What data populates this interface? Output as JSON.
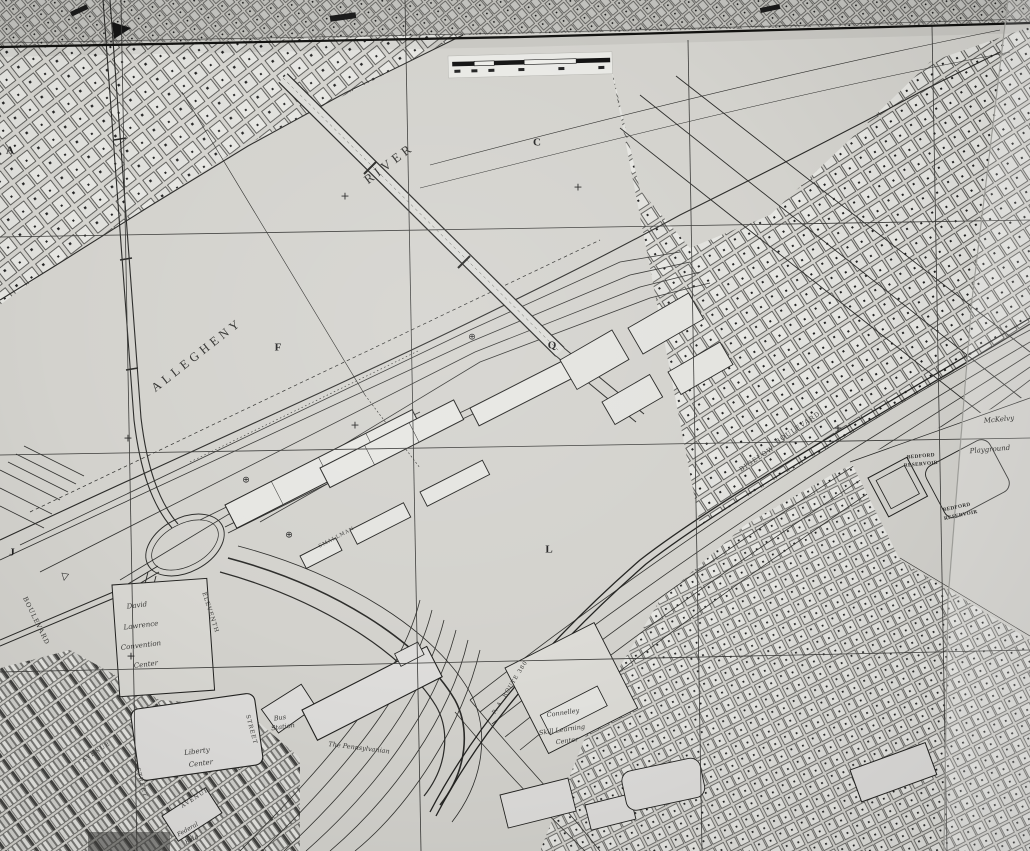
{
  "meta": {
    "kind": "scanned city planning map sheet",
    "colors": {
      "paper": "#d3d2cd",
      "paper_light": "#e2e2de",
      "ink": "#222220"
    }
  },
  "river": {
    "name_word1": "ALLEGHENY",
    "name_word2": "RIVER"
  },
  "grid_letters": {
    "a": "A",
    "c": "C",
    "f": "F",
    "q": "Q",
    "j": "J",
    "l": "L"
  },
  "places": {
    "convention_center": {
      "l1": "David",
      "l2": "Lawrence",
      "l3": "Convention",
      "l4": "Center"
    },
    "liberty_center": {
      "l1": "Liberty",
      "l2": "Center"
    },
    "federal_building": {
      "l1": "Federal",
      "l2": "Bldg"
    },
    "bus_station": {
      "l1": "Bus",
      "l2": "Station"
    },
    "pennsylvanian": {
      "l1": "The Pennsylvanian"
    },
    "connelley": {
      "l1": "Connelley",
      "l2": "Skill Learning",
      "l3": "Center"
    },
    "mckelvy": {
      "l1": "McKelvy",
      "l2": "Playground"
    },
    "bedford_reservoir_upper": {
      "l1": "BEDFORD",
      "l2": "RESERVOIR"
    },
    "bedford_reservoir_lower": {
      "l1": "BEDFORD",
      "l2": "RESERVOIR"
    }
  },
  "streets": {
    "boulevard": "BOULEVARD",
    "eleventh": "ELEVENTH",
    "smallman": "SMALLMAN",
    "bigelow": "BIGELOW",
    "bigelow_blvd": "BOULEVARD",
    "route_380": "P. A. ROUTE 380",
    "avenue_1": "AVENUE",
    "avenue_2": "AVENUE",
    "street_1": "STREET",
    "street_2": "STREET"
  },
  "symbols": {
    "survey_cross": "+",
    "benchmark": "⊕",
    "triangle_marker": "▷"
  }
}
